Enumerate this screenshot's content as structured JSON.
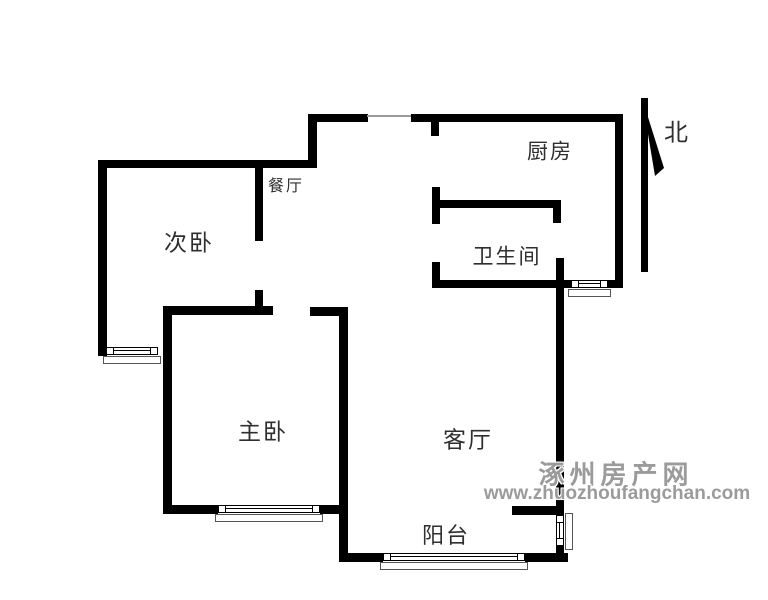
{
  "page": {
    "background": "#ffffff",
    "width": 768,
    "height": 600
  },
  "floorplan": {
    "wall_color": "#000000",
    "rooms": [
      {
        "id": "bedroom2",
        "label": "次卧",
        "cx": 189,
        "cy": 243,
        "size": 23
      },
      {
        "id": "dining",
        "label": "餐厅",
        "cx": 286,
        "cy": 187,
        "size": 16
      },
      {
        "id": "kitchen",
        "label": "厨房",
        "cx": 550,
        "cy": 152,
        "size": 21
      },
      {
        "id": "bathroom",
        "label": "卫生间",
        "cx": 507,
        "cy": 257,
        "size": 21
      },
      {
        "id": "master-bedroom",
        "label": "主卧",
        "cx": 263,
        "cy": 432,
        "size": 23
      },
      {
        "id": "living-room",
        "label": "客厅",
        "cx": 468,
        "cy": 440,
        "size": 23
      },
      {
        "id": "balcony",
        "label": "阳台",
        "cx": 446,
        "cy": 536,
        "size": 22
      }
    ],
    "north": {
      "label": "北",
      "cx": 676,
      "cy": 130,
      "size": 24
    },
    "walls": [
      {
        "name": "top-wall-west",
        "x": 308,
        "y": 114,
        "w": 60,
        "h": 8
      },
      {
        "name": "top-wall-east",
        "x": 411,
        "y": 114,
        "w": 212,
        "h": 8
      },
      {
        "name": "entry-left-wall",
        "x": 308,
        "y": 114,
        "w": 9,
        "h": 54
      },
      {
        "name": "bedroom2-top-wall",
        "x": 98,
        "y": 160,
        "w": 219,
        "h": 8
      },
      {
        "name": "bedroom2-left-wall",
        "x": 98,
        "y": 160,
        "w": 9,
        "h": 196
      },
      {
        "name": "bedroom2-hall-wall",
        "x": 255,
        "y": 163,
        "w": 8,
        "h": 78
      },
      {
        "name": "bedroom2-hall-stub",
        "x": 255,
        "y": 290,
        "w": 8,
        "h": 17
      },
      {
        "name": "kitchen-entry-stub",
        "x": 431,
        "y": 122,
        "w": 8,
        "h": 14
      },
      {
        "name": "bathroom-left-wall-upper",
        "x": 432,
        "y": 187,
        "w": 8,
        "h": 37
      },
      {
        "name": "bathroom-left-wall-lower",
        "x": 432,
        "y": 262,
        "w": 8,
        "h": 26
      },
      {
        "name": "bathroom-top-wall",
        "x": 440,
        "y": 200,
        "w": 121,
        "h": 8
      },
      {
        "name": "bathroom-top-right-stub",
        "x": 553,
        "y": 208,
        "w": 8,
        "h": 15
      },
      {
        "name": "bathroom-bottom-wall-west",
        "x": 432,
        "y": 280,
        "w": 139,
        "h": 8
      },
      {
        "name": "bathroom-bottom-wall-east",
        "x": 608,
        "y": 280,
        "w": 15,
        "h": 8
      },
      {
        "name": "kitchen-right-wall",
        "x": 615,
        "y": 114,
        "w": 8,
        "h": 174
      },
      {
        "name": "living-right-wall",
        "x": 556,
        "y": 258,
        "w": 8,
        "h": 257
      },
      {
        "name": "master-top-wall",
        "x": 163,
        "y": 306,
        "w": 110,
        "h": 9
      },
      {
        "name": "living-left-top-wall",
        "x": 310,
        "y": 307,
        "w": 38,
        "h": 9
      },
      {
        "name": "master-left-wall",
        "x": 163,
        "y": 306,
        "w": 9,
        "h": 208
      },
      {
        "name": "master-living-wall",
        "x": 339,
        "y": 307,
        "w": 9,
        "h": 255
      },
      {
        "name": "master-bottom-wall-west",
        "x": 163,
        "y": 505,
        "w": 55,
        "h": 9
      },
      {
        "name": "master-bottom-wall-east",
        "x": 320,
        "y": 505,
        "w": 28,
        "h": 9
      },
      {
        "name": "living-bottom-wall",
        "x": 512,
        "y": 506,
        "w": 52,
        "h": 9
      },
      {
        "name": "balcony-bottom-wall-west",
        "x": 343,
        "y": 553,
        "w": 40,
        "h": 9
      },
      {
        "name": "balcony-bottom-wall-east",
        "x": 525,
        "y": 553,
        "w": 43,
        "h": 9
      },
      {
        "name": "balcony-right-corner",
        "x": 556,
        "y": 546,
        "w": 8,
        "h": 16
      }
    ],
    "windows": [
      {
        "name": "bedroom2-window",
        "orient": "h",
        "x": 106,
        "y": 347,
        "len": 52
      },
      {
        "name": "master-window",
        "orient": "h",
        "x": 218,
        "y": 505,
        "len": 102
      },
      {
        "name": "balcony-window",
        "orient": "h",
        "x": 383,
        "y": 553,
        "len": 142
      },
      {
        "name": "bathroom-window",
        "orient": "h",
        "x": 571,
        "y": 280,
        "len": 37
      },
      {
        "name": "balcony-side-window",
        "orient": "v",
        "x": 556,
        "y": 515,
        "len": 31
      }
    ],
    "openings": [
      {
        "name": "entry-door-line",
        "x": 367,
        "y": 115,
        "w": 44,
        "h": 2,
        "color": "#9a9a9a"
      }
    ]
  },
  "watermark": {
    "line1": "涿州房产网",
    "line2": "www.zhuozhoufangchan.com",
    "color": "#9b9b9b"
  }
}
